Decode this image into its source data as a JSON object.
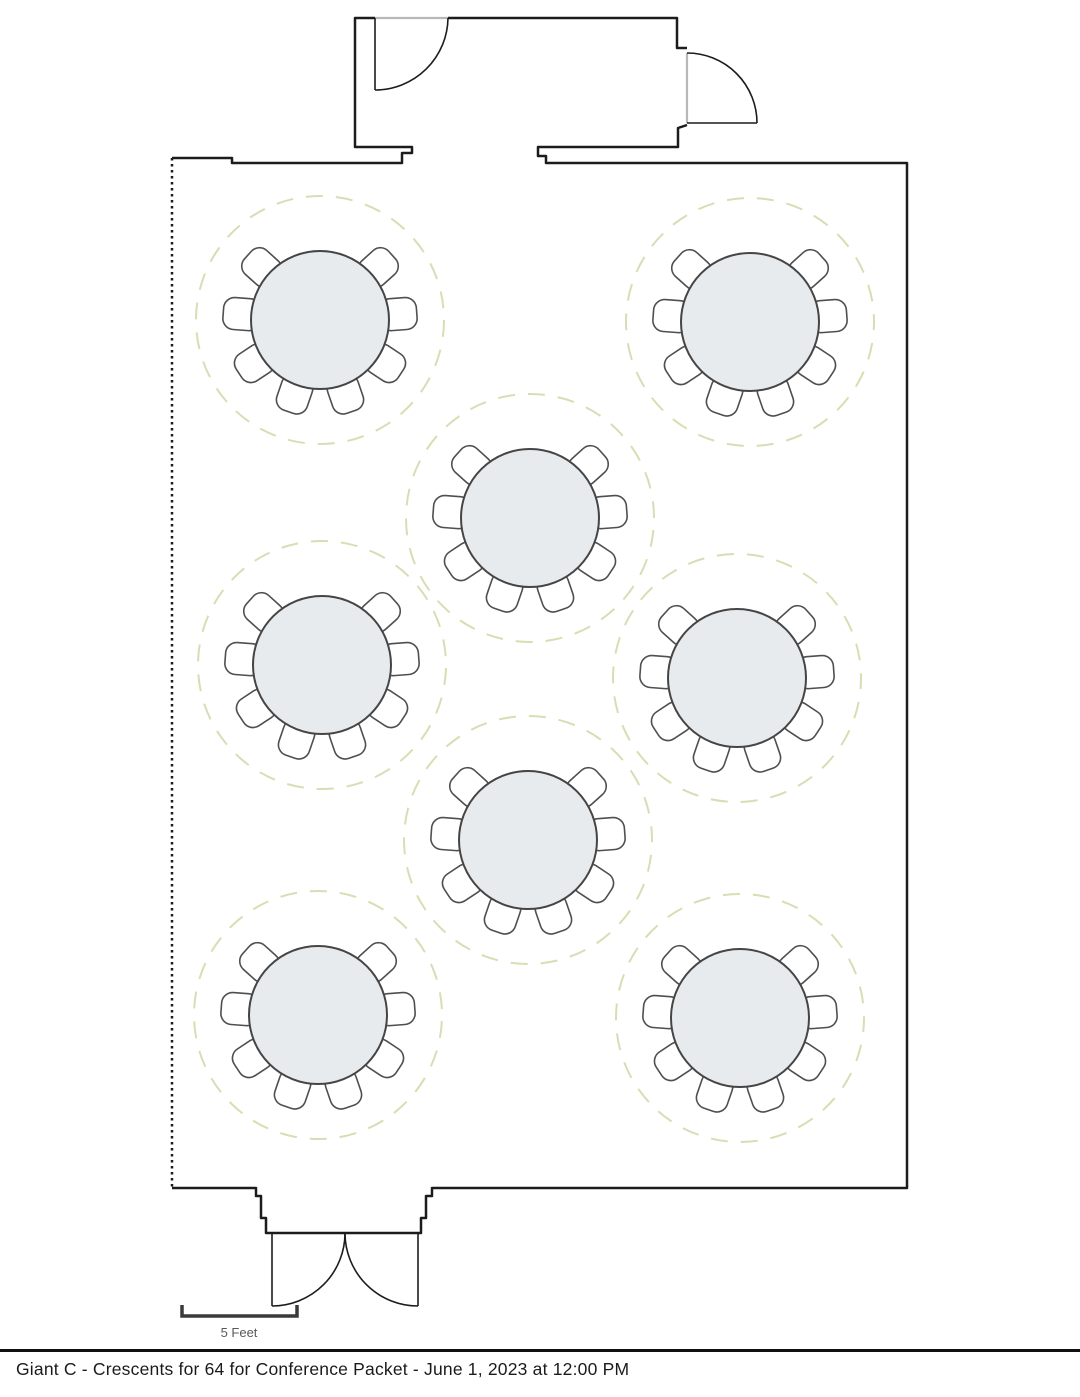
{
  "caption": {
    "text": "Giant C  - Crescents for 64 for Conference Packet - June 1, 2023 at 12:00 PM"
  },
  "scale_bar": {
    "label": "5 Feet"
  },
  "colors": {
    "wall": "#1c1c1c",
    "door": "#1c1c1c",
    "opening": "#b8b8b8",
    "table_fill": "#e7ebee",
    "table_stroke": "#454545",
    "chair_stroke": "#4f4f4f",
    "chair_fill": "#ffffff",
    "clearance": "#d9ddb3",
    "scale_bar": "#3a3a3a",
    "scale_label": "#5a5a5a"
  },
  "floorplan": {
    "type": "banquet-room-layout",
    "seating_style": "crescent rounds",
    "tables_count": 8,
    "chairs_per_table": 8,
    "total_seats": 64,
    "table_radius": 69,
    "clearance_radius": 124,
    "chair_angles_deg": [
      48,
      85.7,
      123.4,
      161.1,
      198.9,
      236.6,
      274.3,
      312
    ],
    "tables": [
      {
        "id": 1,
        "x": 320,
        "y": 320
      },
      {
        "id": 2,
        "x": 750,
        "y": 322
      },
      {
        "id": 3,
        "x": 530,
        "y": 518
      },
      {
        "id": 4,
        "x": 322,
        "y": 665
      },
      {
        "id": 5,
        "x": 737,
        "y": 678
      },
      {
        "id": 6,
        "x": 528,
        "y": 840
      },
      {
        "id": 7,
        "x": 318,
        "y": 1015
      },
      {
        "id": 8,
        "x": 740,
        "y": 1018
      }
    ]
  }
}
